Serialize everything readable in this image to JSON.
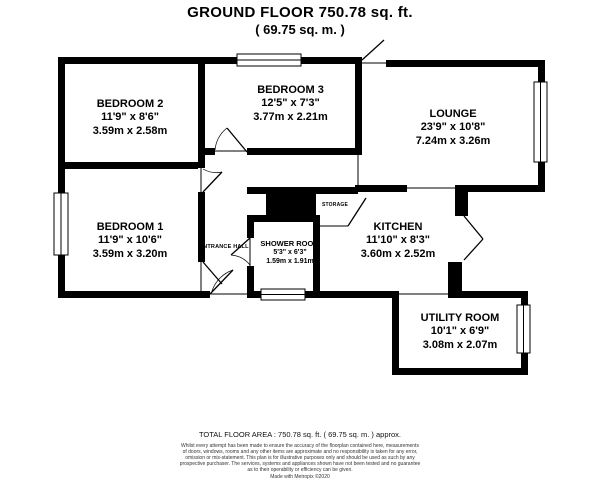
{
  "title": {
    "line1": "GROUND FLOOR 750.78 sq. ft.",
    "line2": "( 69.75 sq. m. )"
  },
  "rooms": {
    "bedroom2": {
      "name": "BEDROOM 2",
      "imperial": "11'9\" x 8'6\"",
      "metric": "3.59m x 2.58m"
    },
    "bedroom3": {
      "name": "BEDROOM 3",
      "imperial": "12'5\" x 7'3\"",
      "metric": "3.77m x 2.21m"
    },
    "lounge": {
      "name": "LOUNGE",
      "imperial": "23'9\" x 10'8\"",
      "metric": "7.24m x 3.26m"
    },
    "bedroom1": {
      "name": "BEDROOM 1",
      "imperial": "11'9\" x 10'6\"",
      "metric": "3.59m x 3.20m"
    },
    "kitchen": {
      "name": "KITCHEN",
      "imperial": "11'10\" x 8'3\"",
      "metric": "3.60m x 2.52m"
    },
    "utility": {
      "name": "UTILITY ROOM",
      "imperial": "10'1\" x 6'9\"",
      "metric": "3.08m x 2.07m"
    },
    "shower": {
      "name": "SHOWER ROOM",
      "imperial": "5'3\" x 6'3\"",
      "metric": "1.59m x 1.91m"
    },
    "entrance_hall": {
      "name": "ENTRANCE HALL"
    },
    "storage": {
      "name": "STORAGE"
    }
  },
  "footer": {
    "total": "TOTAL FLOOR AREA : 750.78 sq. ft. ( 69.75 sq. m. ) approx.",
    "disclaimer_lines": [
      "Whilst every attempt has been made to ensure the accuracy of the floorplan contained here, measurements",
      "of doors, windows, rooms and any other items are approximate and no responsibility is taken for any error,",
      "omission or mis-statement. This plan is for illustrative purposes only and should be used as such by any",
      "prospective purchaser. The services, systems and appliances shown have not been tested and no guarantee",
      "as to their operability or efficiency can be given.",
      "Made with Metropix ©2020"
    ]
  },
  "colors": {
    "wall": "#000000",
    "background": "#ffffff"
  }
}
